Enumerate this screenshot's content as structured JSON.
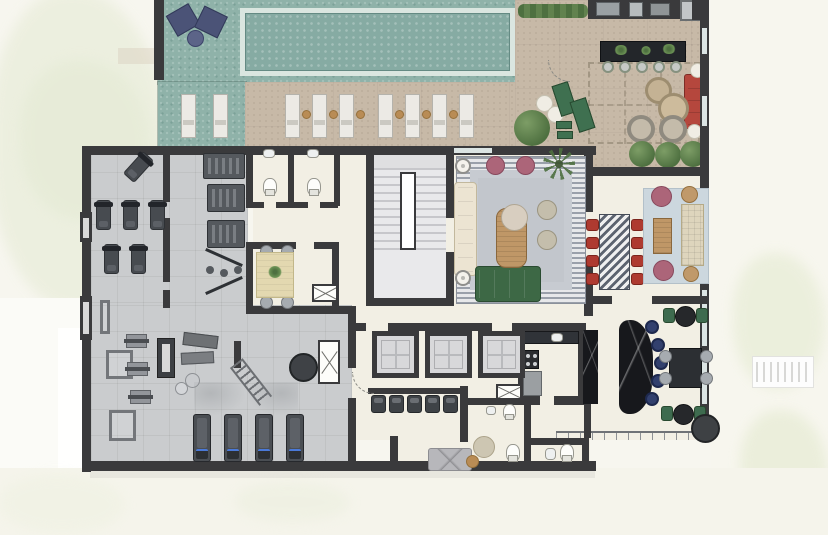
{
  "meta": {
    "title": "Residential amenities floor plan — top-down architectural rendering",
    "type": "architectural-floor-plan",
    "view": "top-down",
    "has_visible_text": false
  },
  "palette": {
    "wall": "#3a3a3c",
    "floor": "#f2efe4",
    "gym_floor": "#caccce",
    "deck": "#8fb2a9",
    "pool": "#86aba3",
    "pool_coping": "#dae6e0",
    "terrace": "#c7b9a7",
    "lawn": "#eaeedb",
    "path": "#fbfbf8",
    "red": "#ae3a30",
    "green": "#3e6b4f",
    "navy": "#32406e",
    "pink": "#ac6579",
    "wood": "#bf9767",
    "rug": "#c7cbd1",
    "rug_blue": "#ccd7de",
    "marble": "#17181c",
    "sofa_green": "#3d6845",
    "cream_sofa": "#ece4d2",
    "gold": "#b98c55"
  },
  "areas": [
    {
      "id": "pool",
      "label": "Swimming pool"
    },
    {
      "id": "pool-deck",
      "label": "Pool deck (teal tile)"
    },
    {
      "id": "sun-deck",
      "label": "Sun deck with loungers"
    },
    {
      "id": "terrace-lounge",
      "label": "Outdoor lounge terrace with pergola and barbecue counter"
    },
    {
      "id": "spinning-studio",
      "label": "Spinning studio"
    },
    {
      "id": "fitness-room",
      "label": "Fitness and weights room"
    },
    {
      "id": "restrooms-upper",
      "label": "Restrooms (upper pair)"
    },
    {
      "id": "meeting-room",
      "label": "Meeting room"
    },
    {
      "id": "staircase",
      "label": "Staircase"
    },
    {
      "id": "reading-lounge",
      "label": "Reading lounge"
    },
    {
      "id": "dining-room",
      "label": "Private dining room"
    },
    {
      "id": "games-bar-lounge",
      "label": "Bar and games lounge"
    },
    {
      "id": "kitchen",
      "label": "Support kitchen"
    },
    {
      "id": "elevator-lobby",
      "label": "Elevator lobby with waiting seats"
    },
    {
      "id": "restrooms-lower",
      "label": "Restrooms (lower)"
    }
  ],
  "inventory": {
    "sun_loungers_white": 9,
    "lounge_chairs_navy": 2,
    "spin_bikes": 6,
    "weight_machines": 3,
    "treadmills": 4,
    "dining_chairs_red": 8,
    "bar_stools_blue": 5,
    "outdoor_bar_stools": 5,
    "elevators": 3,
    "toilets": 5,
    "green_armchairs": 4,
    "sofas": 4
  }
}
